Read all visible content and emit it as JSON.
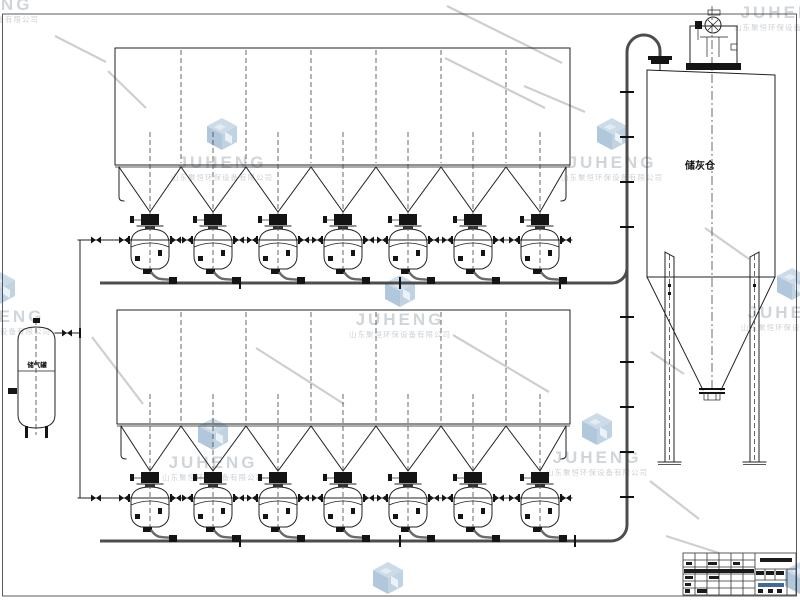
{
  "page": {
    "background": "#ffffff"
  },
  "labels": {
    "silo": "储灰仓",
    "air_tank": "储气罐"
  },
  "watermark": {
    "brand": "JUHENG",
    "company": "山东聚恒环保设备有限公司",
    "brand_color": "#ccd1d6",
    "company_color": "#c9cdd2",
    "logo_top": "#c7d8e6",
    "logo_left": "#a9c2d8",
    "logo_right": "#b9cfe0",
    "diagonal_color": "#cccfd2"
  },
  "equipment": {
    "collector_rows": 2,
    "hoppers_per_row": 7,
    "bin_pumps_per_row": 7,
    "ash_silo_count": 1,
    "air_tank_count": 1
  },
  "colors": {
    "drawing_line": "#222222",
    "conveying_pipe": "#4d4d4d",
    "hose": "#6a6a6a",
    "valve_fill": "#141414",
    "centerline": "#444444",
    "titleblock_text_bar": "#1c1c1c",
    "titleblock_accent": "#3f6a9a"
  }
}
